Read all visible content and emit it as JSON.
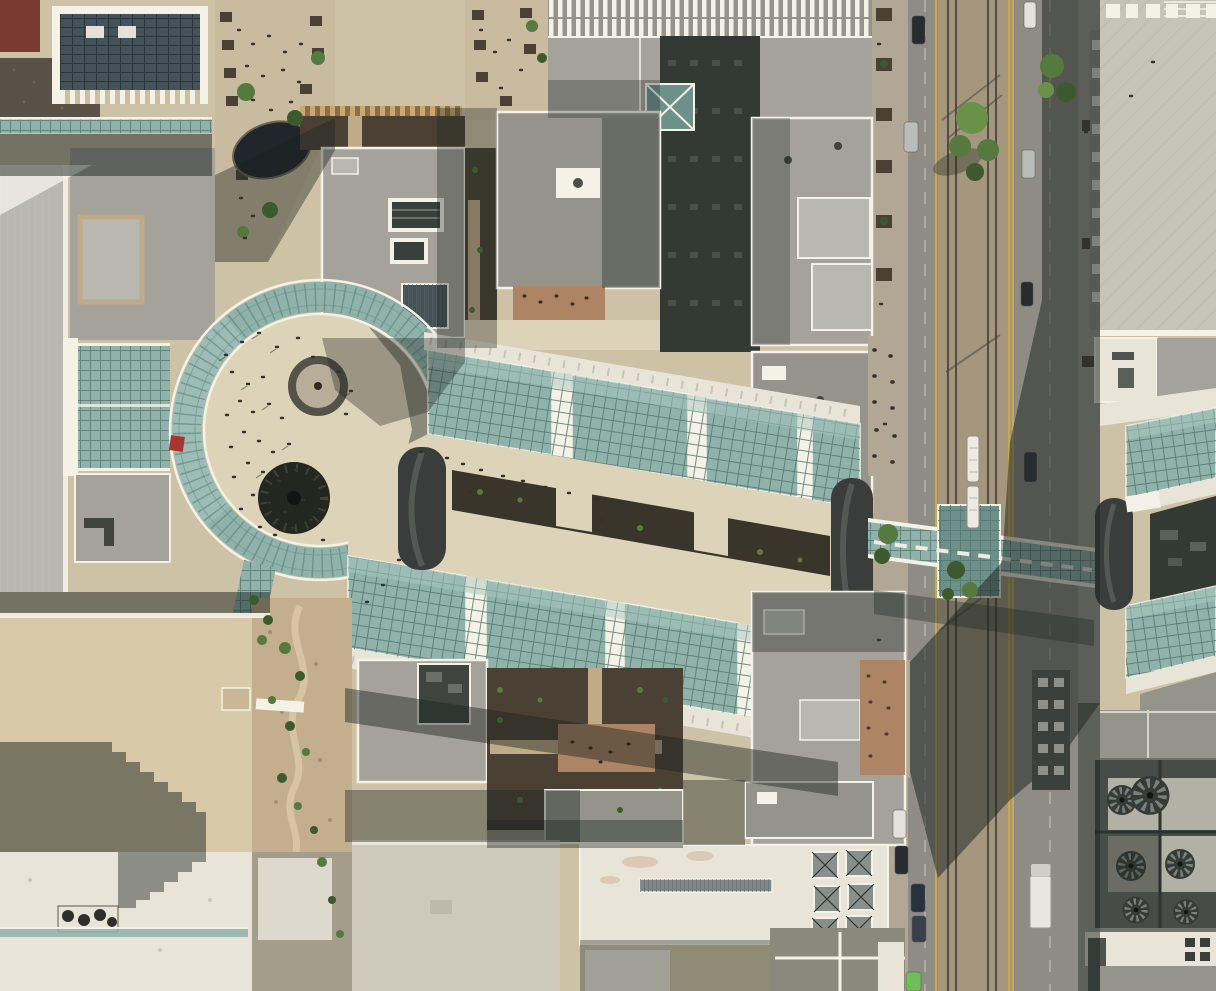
{
  "image": {
    "kind": "aerial-orthographic-photograph",
    "width_px": 1216,
    "height_px": 991
  },
  "scene": {
    "setting": "Overhead aerial photo of a downtown shopping center with retractable teal glass arcade roofs, a circular glass atrium plaza, rooftop gardens, and a glass skybridge crossing a light-rail street",
    "visible_text": [],
    "glass_ring_atrium": {
      "label": "circular glass atrium roof around open plaza",
      "fountain_count": 2,
      "has_people": true,
      "red_canopy": true
    },
    "glass_arcade": {
      "label": "two tilted rows of glass roof panels with creek walkway between",
      "rows": 2,
      "panels_per_row": 4,
      "barrel_arches": 3
    },
    "skybridge": {
      "label": "teal glass pedestrian skybridge over street",
      "has_center_pavilion": true
    },
    "east_arcade": {
      "label": "matching glass arcade east of the street",
      "glass_sections": 2
    },
    "street": {
      "label": "north-south street with light-rail median",
      "rail_count": 4,
      "median": "ballast with trees",
      "lane_lines": "yellow",
      "vehicles": [
        "light-rail train",
        "parked cars",
        "white box truck",
        "green car"
      ]
    },
    "rooftops": {
      "label": "mixed gray, white and tan rooftops",
      "features": [
        "solar-panel roof",
        "ribbed apartment roof",
        "skylight strip",
        "pyramid skylights",
        "HVAC fan wells",
        "stepped shadow on tan roof",
        "rock creek garden",
        "terracotta terraces with cafe tables"
      ]
    },
    "hvac_fan_count": 6,
    "pedestrian_mall": {
      "label": "tree-lined pedestrian mall with dark reflecting pool",
      "has_people": true
    }
  },
  "palette": {
    "plaza": "#cdc2a6",
    "plaza_bright": "#ddd3b8",
    "mall_walk": "#c9bb9f",
    "roof_gray_light": "#b8b8b0",
    "roof_gray": "#a4a29a",
    "roof_gray_mid": "#94948b",
    "roof_gray_dark": "#70736d",
    "roof_white": "#e8e4d8",
    "parapet": "#f4f1e7",
    "roof_tan": "#d8c9a8",
    "roof_cream": "#cdc9bb",
    "roof_slate": "#46525a",
    "roof_gravel": "#5a5146",
    "awning_tan": "#c9a96f",
    "awning_brown": "#8a6f4a",
    "stripe_tan": "#cbbd9e",
    "glass_teal": "#8fb3ab",
    "glass_teal_light": "#aac8c0",
    "glass_teal_dark": "#6d918a",
    "glass_mullion": "#54736d",
    "court_dark": "#333a33",
    "soil": "#4a4134",
    "soil_dark": "#3a352a",
    "terracotta": "#ad8565",
    "path_tan": "#c0ab88",
    "creek_rock": "#c3ae8d",
    "street": "#8e8c84",
    "sidewalk": "#b1a794",
    "sidewalk2": "#a19f94",
    "ballast": "#a4977e",
    "rail": "#524e46",
    "lane_yellow": "#c9aa4f",
    "lane_white": "#d8d5cb",
    "tree": "#55793f",
    "tree_bright": "#699147",
    "tree_dark": "#3c5a2e",
    "shadow": "#1c2420",
    "water_dark": "#20262a",
    "fountain_dark": "#23271f",
    "red_accent": "#a83430",
    "car_white": "#e3e1d9",
    "car_dark": "#272c2f",
    "car_silver": "#b9bdb9",
    "car_green": "#6fbe5a",
    "car_blue": "#26323e",
    "train_white": "#eceae2",
    "arch_dark": "#3a3d3b",
    "arch_light": "#5c605d",
    "hvac_deck": "#b2b1a6",
    "hvac_dark": "#474c47",
    "hvac_blade": "#79807a",
    "plaza_roof": "#c6c4b9",
    "people": "#33332e"
  }
}
